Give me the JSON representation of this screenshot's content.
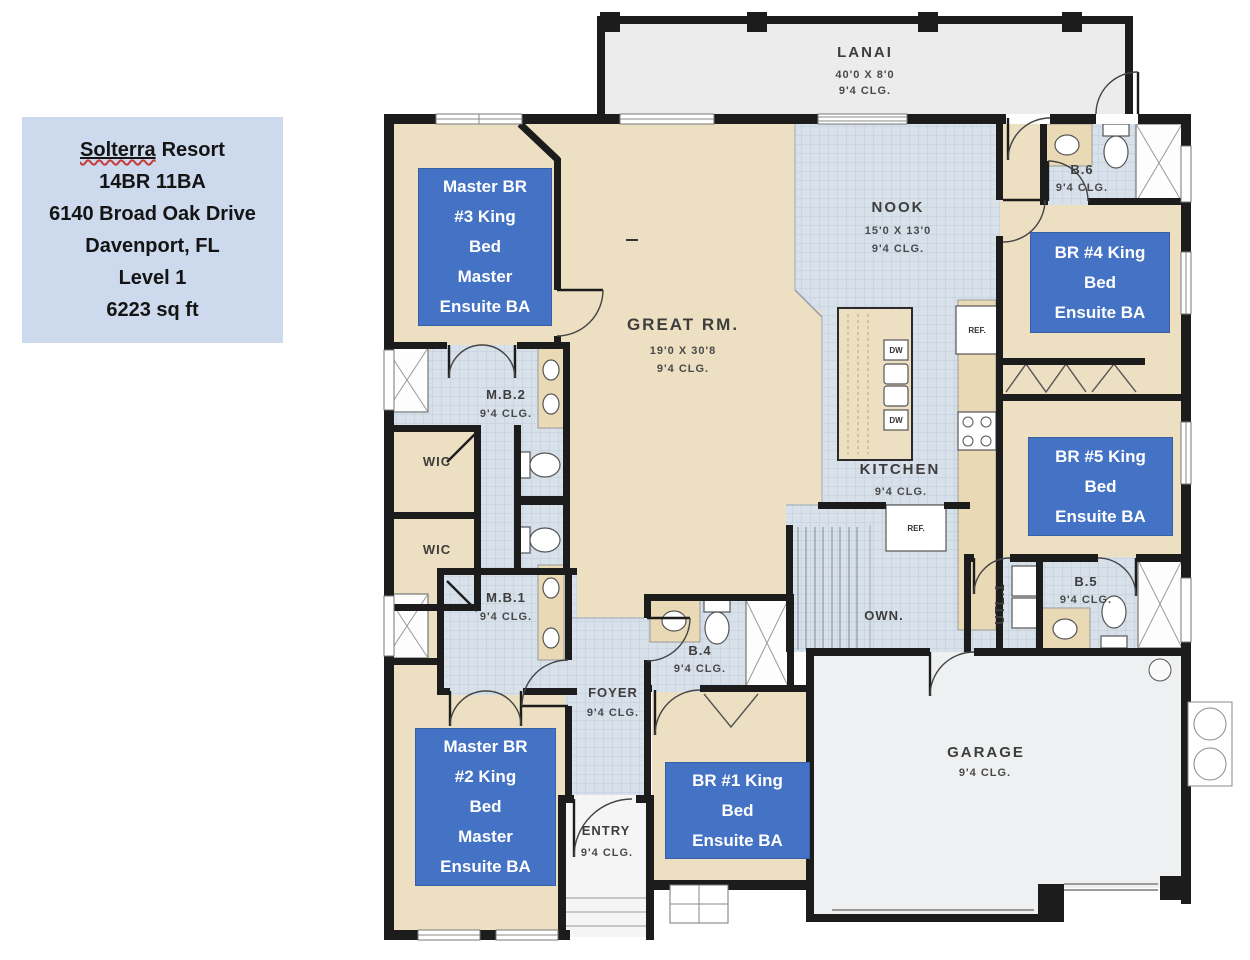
{
  "colors": {
    "label_blue": "#4472c4",
    "info_box_bg": "#cdd9ec",
    "floor_tan": "#ecdfc2",
    "floor_tile": "#d8e1ea",
    "wall_black": "#1c1c1c"
  },
  "info_box": {
    "title_word": "Solterra",
    "title_rest": "Resort",
    "lines": [
      "14BR 11BA",
      "6140 Broad Oak Drive",
      "Davenport, FL",
      "Level 1",
      "6223 sq ft"
    ]
  },
  "rooms": {
    "lanai": {
      "name": "LANAI",
      "dim": "40'0 X 8'0",
      "clg": "9'4 CLG."
    },
    "great_room": {
      "name": "GREAT RM.",
      "dim": "19'0 X 30'8",
      "clg": "9'4 CLG."
    },
    "nook": {
      "name": "NOOK",
      "dim": "15'0 X 13'0",
      "clg": "9'4 CLG."
    },
    "kitchen": {
      "name": "KITCHEN",
      "clg": "9'4 CLG."
    },
    "mb2": {
      "name": "M.B.2",
      "clg": "9'4 CLG."
    },
    "mb1": {
      "name": "M.B.1",
      "clg": "9'4 CLG."
    },
    "wic1": {
      "name": "WIC"
    },
    "wic2": {
      "name": "WIC"
    },
    "b4": {
      "name": "B.4",
      "clg": "9'4 CLG."
    },
    "b5": {
      "name": "B.5",
      "clg": "9'4 CLG."
    },
    "b6": {
      "name": "B.6",
      "clg": "9'4 CLG."
    },
    "utility": {
      "name": "UTL.1"
    },
    "stairs": {
      "name": "OWN."
    },
    "foyer": {
      "name": "FOYER",
      "clg": "9'4 CLG."
    },
    "entry": {
      "name": "ENTRY",
      "clg": "9'4 CLG."
    },
    "garage": {
      "name": "GARAGE",
      "clg": "9'4 CLG."
    }
  },
  "fixtures": {
    "fridge": "REF.",
    "dishwasher": "DW"
  },
  "bed_labels": [
    {
      "id": "master-br-3",
      "lines": [
        "Master BR",
        "#3 King",
        "Bed",
        "Master",
        "Ensuite BA"
      ]
    },
    {
      "id": "br-4",
      "lines": [
        "BR #4 King",
        "Bed",
        "Ensuite BA"
      ]
    },
    {
      "id": "br-5",
      "lines": [
        "BR #5 King",
        "Bed",
        "Ensuite BA"
      ]
    },
    {
      "id": "master-br-2",
      "lines": [
        "Master BR",
        "#2 King",
        "Bed",
        "Master",
        "Ensuite BA"
      ]
    },
    {
      "id": "br-1",
      "lines": [
        "BR #1 King",
        "Bed",
        "Ensuite BA"
      ]
    }
  ]
}
